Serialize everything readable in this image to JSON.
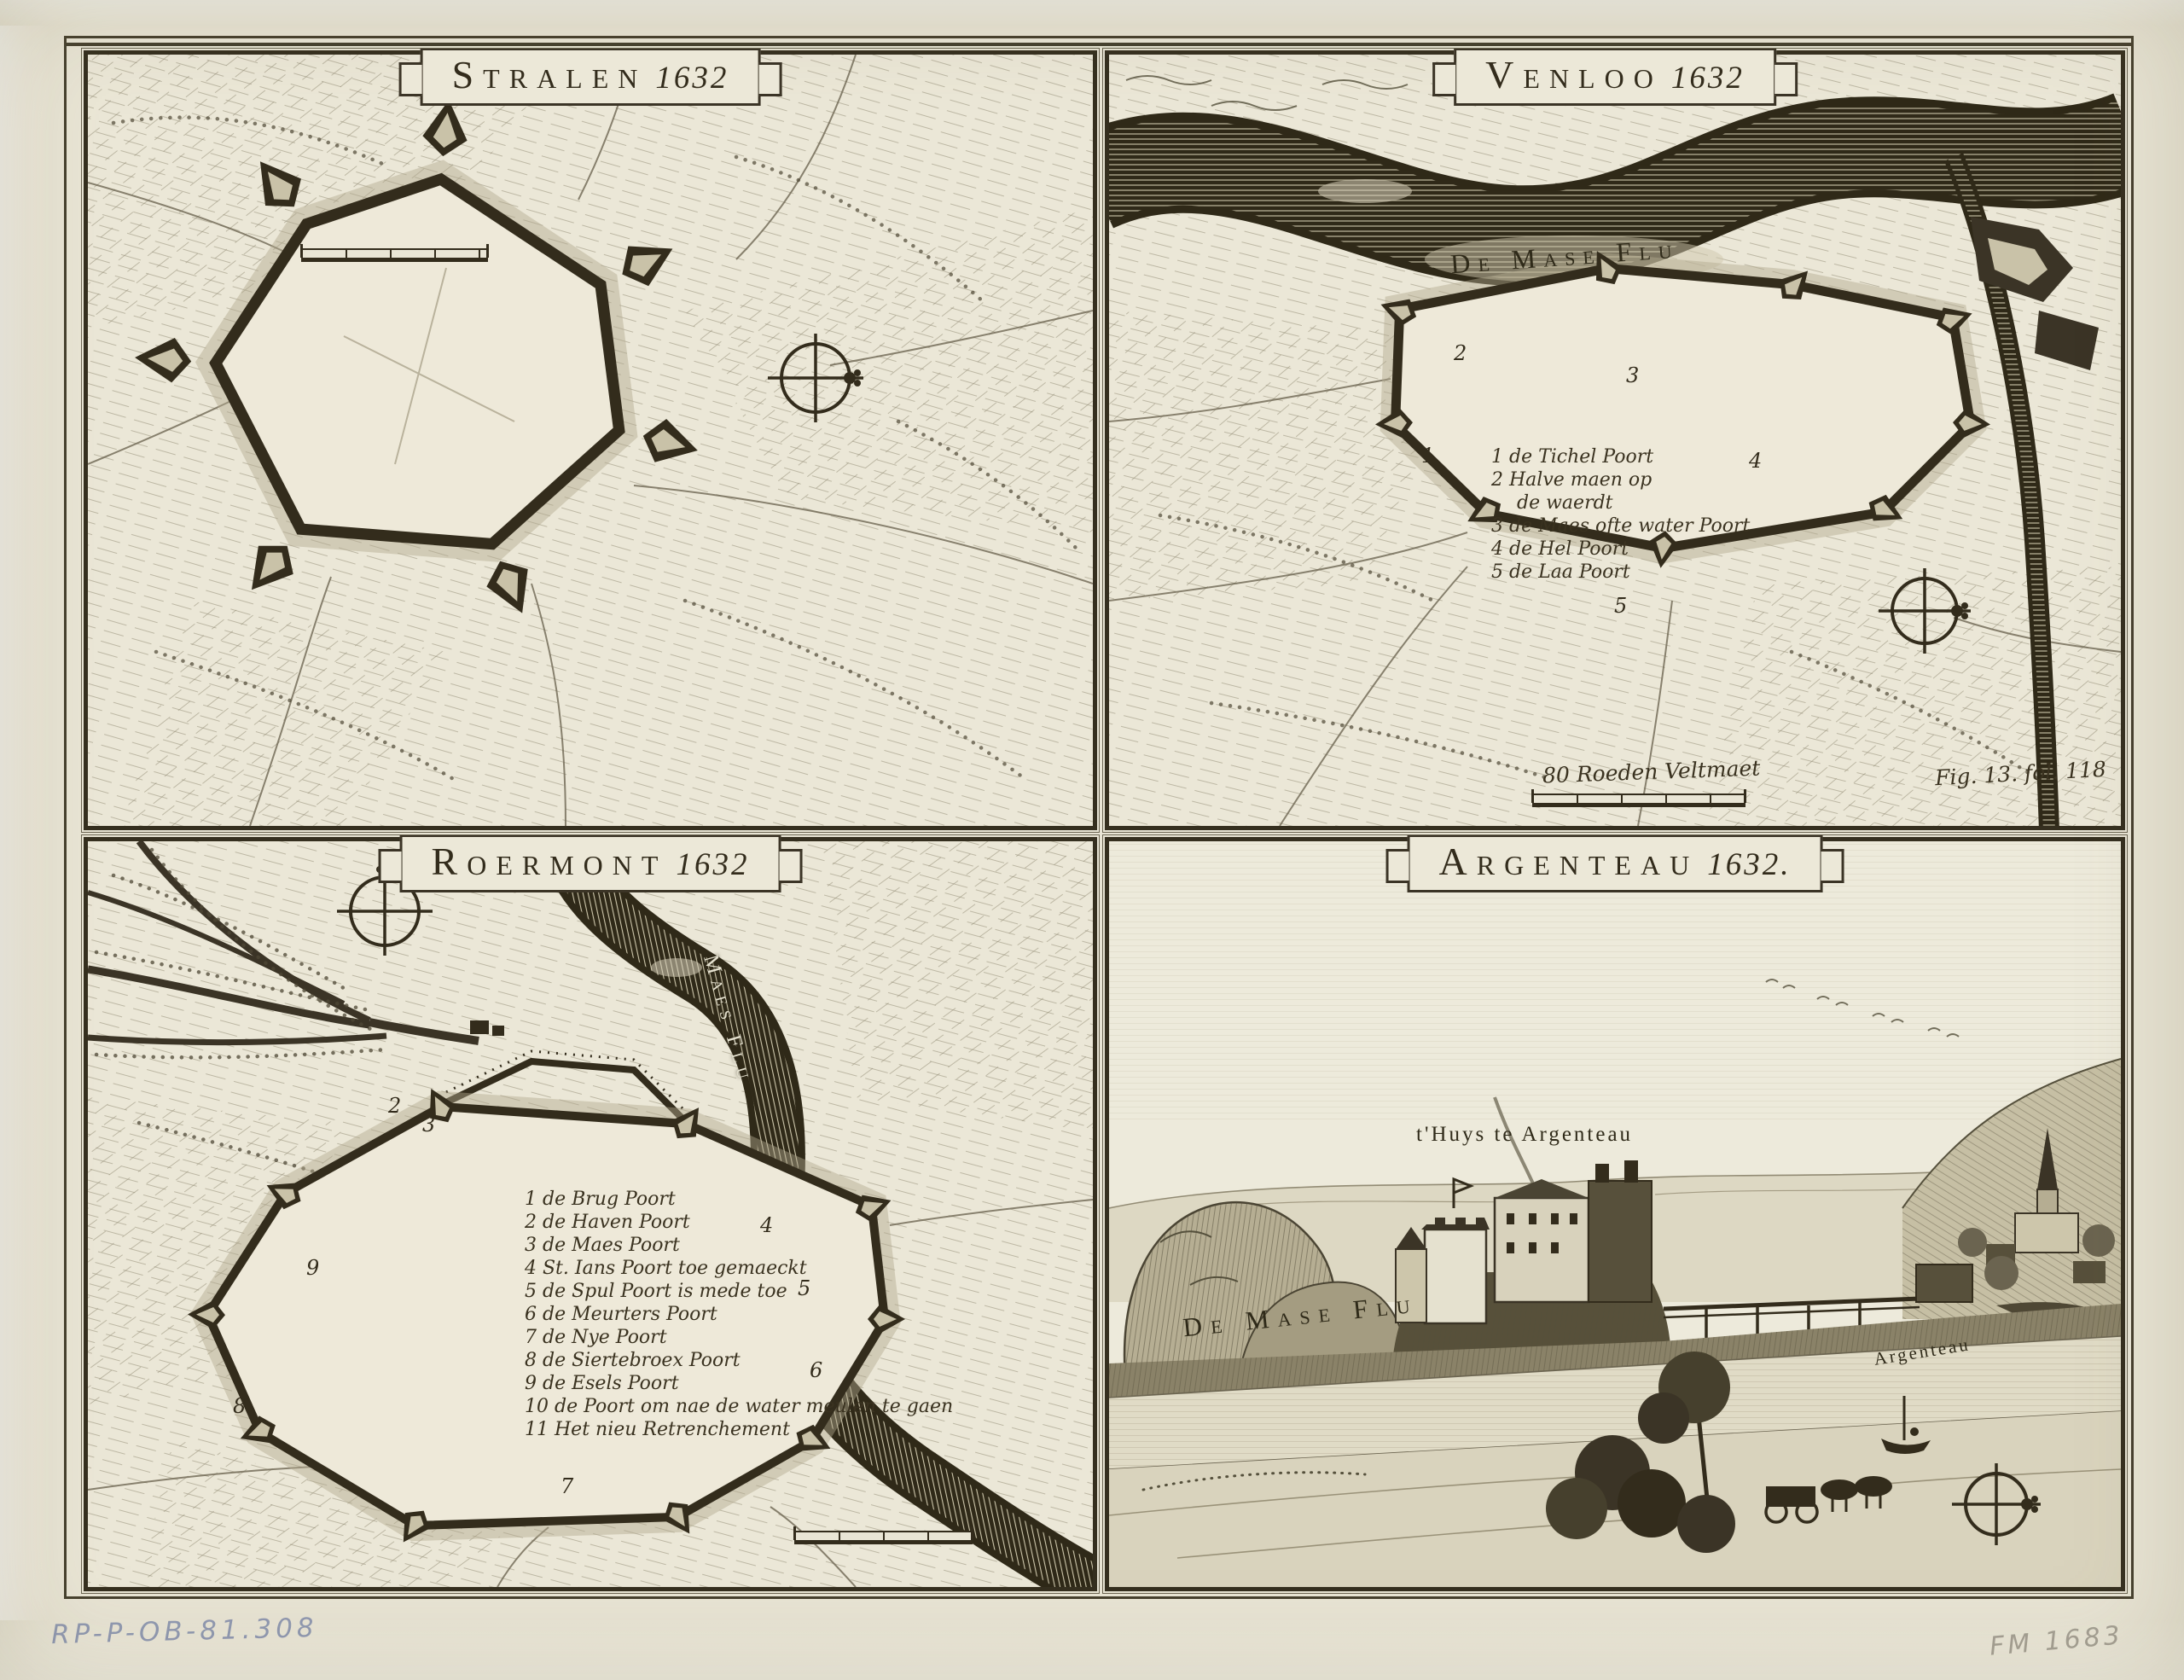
{
  "panels": {
    "stralen": {
      "title": "Stralen",
      "year": "1632"
    },
    "venloo": {
      "title": "Venloo",
      "year": "1632",
      "river_label": "De Mase Flu",
      "legend": [
        "1 de Tichel Poort",
        "2 Halve maen op",
        "de waerdt",
        "3 de Maes ofte water Poort",
        "4 de Hel Poort",
        "5 de Laa Poort"
      ],
      "plan_numbers": [
        "1",
        "2",
        "3",
        "4",
        "5"
      ],
      "scale_label": "80 Roeden Veltmaet",
      "figure_ref": "Fig. 13. fol. 118"
    },
    "roermont": {
      "title": "Roermont",
      "year": "1632",
      "river_label": "Maes Flu",
      "legend": [
        "1 de Brug Poort",
        "2 de Haven Poort",
        "3 de Maes Poort",
        "4 St. Ians Poort toe gemaeckt",
        "5 de Spul Poort is mede toe",
        "6 de Meurters Poort",
        "7 de Nye Poort",
        "8 de Siertebroex Poort",
        "9 de Esels Poort",
        "10 de Poort om nae de water meulen te gaen",
        "11 Het nieu Retrenchement"
      ],
      "plan_numbers": [
        "2",
        "3",
        "4",
        "5",
        "6",
        "7",
        "8",
        "9"
      ]
    },
    "argenteau": {
      "title": "Argenteau",
      "year": "1632.",
      "castle_label": "t'Huys te Argenteau",
      "river_label": "De Mase Flu",
      "village_label": "Argenteau"
    }
  },
  "annotations": {
    "inventory_number": "RP-P-OB-81.308",
    "pencil_mark": "FM 1683"
  },
  "icons": {
    "compass_rose": "circle-with-cross"
  },
  "colors": {
    "paper": "#e8e4d4",
    "ink": "#332c1c",
    "annotation_blue": "#8791ae",
    "annotation_gray": "#a5a094"
  }
}
